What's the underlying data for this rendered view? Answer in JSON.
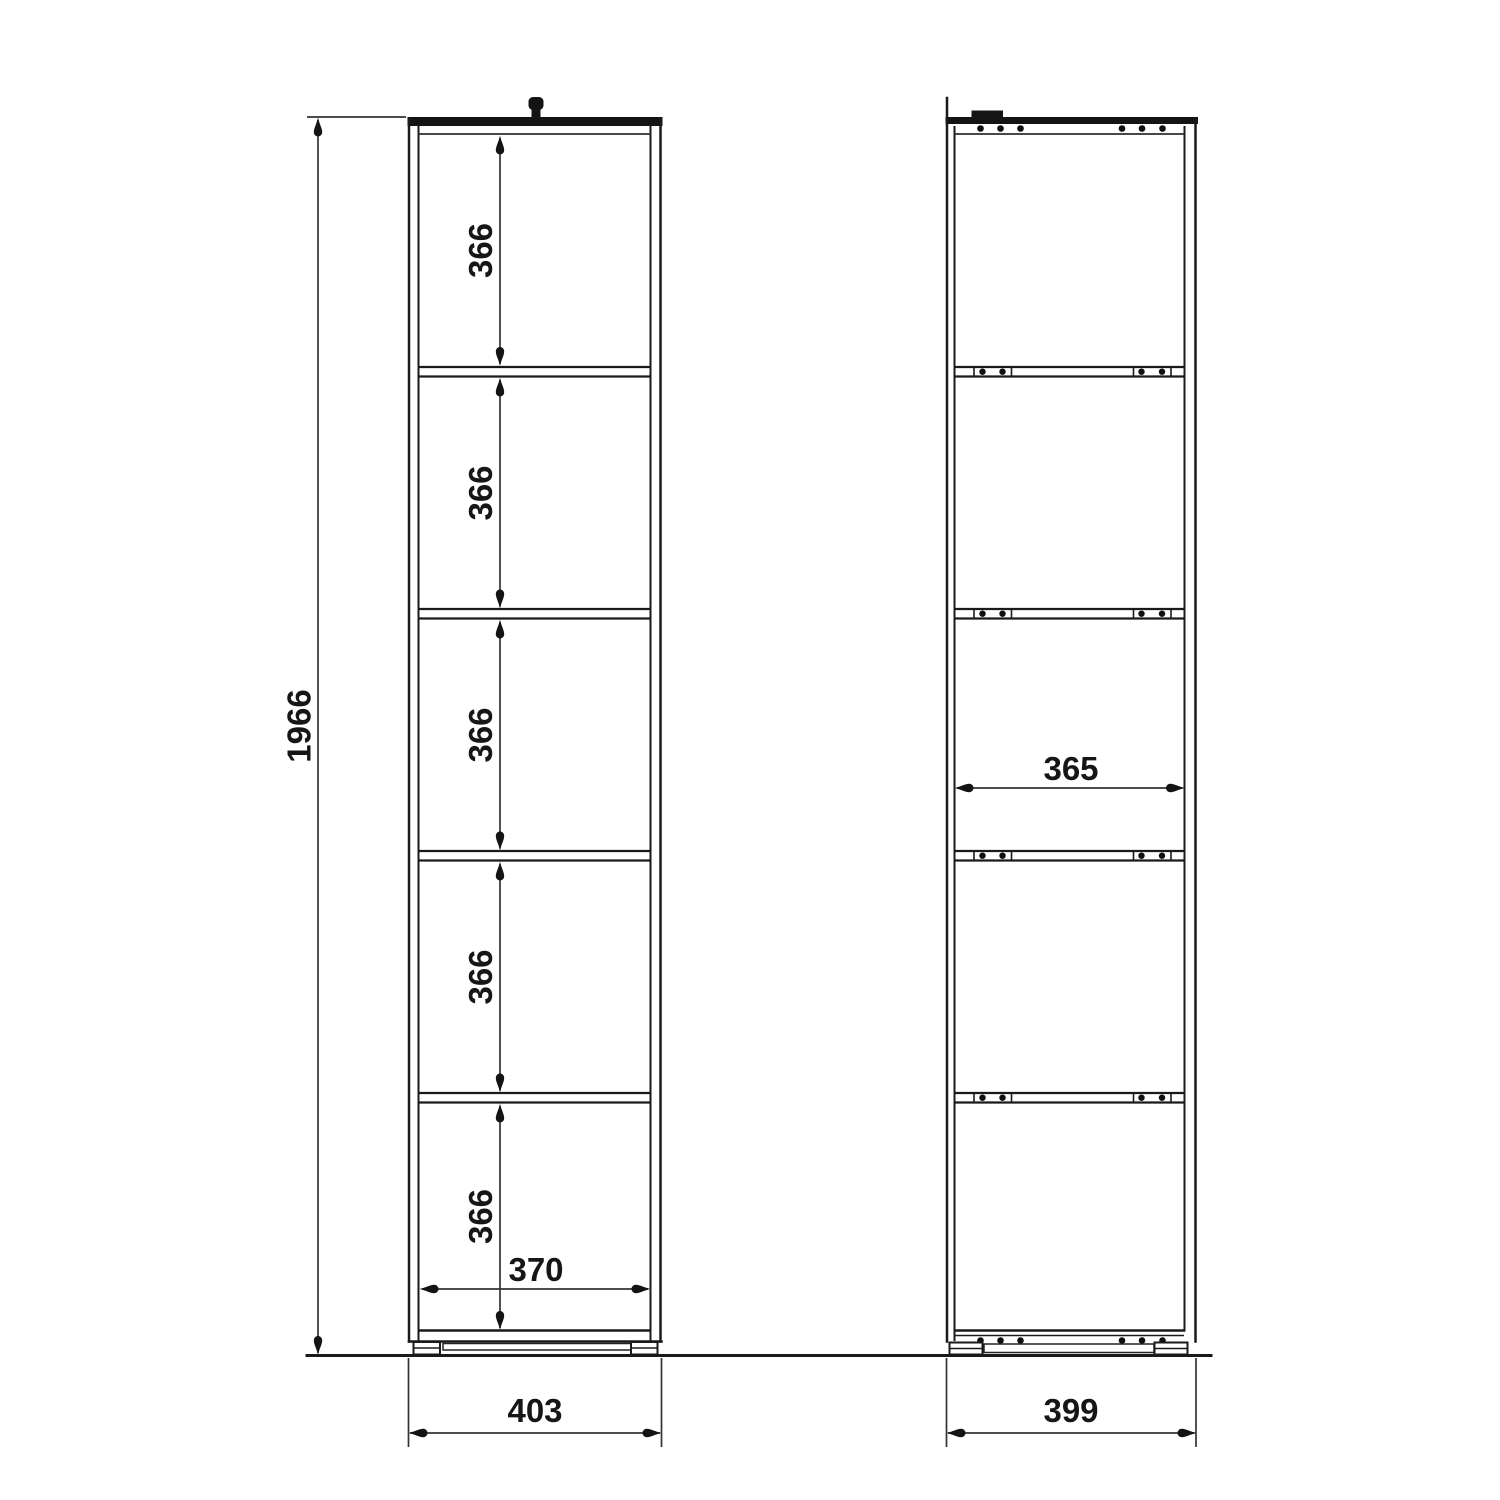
{
  "drawing": {
    "front_view": {
      "overall_height": "1966",
      "compartments": [
        "366",
        "366",
        "366",
        "366",
        "366"
      ],
      "interior_width": "370",
      "overall_width": "403"
    },
    "side_view": {
      "interior_depth": "365",
      "overall_depth": "399"
    }
  }
}
